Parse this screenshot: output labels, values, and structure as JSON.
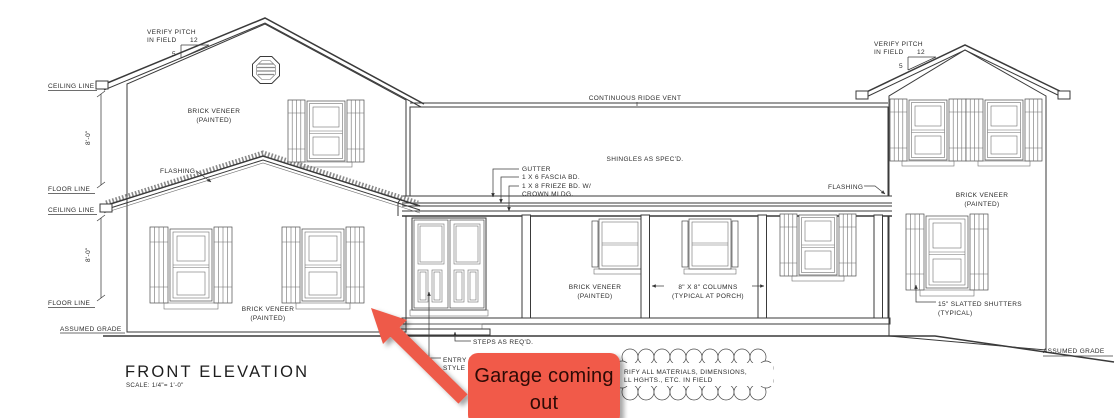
{
  "drawing": {
    "title": "FRONT ELEVATION",
    "scale_note": "SCALE: 1/4\"= 1'-0\"",
    "labels": {
      "verify_pitch": "VERIFY PITCH",
      "in_field": "IN FIELD",
      "pitch_run": "12",
      "pitch_rise": "5",
      "ceiling_line": "CEILING LINE",
      "floor_line": "FLOOR LINE",
      "dim_8ft": "8'-0\"",
      "assumed_grade": "ASSUMED GRADE",
      "brick_veneer": "BRICK VENEER",
      "painted": "(PAINTED)",
      "flashing": "FLASHING",
      "ridge_vent": "CONTINUOUS RIDGE VENT",
      "shingles": "SHINGLES AS SPEC'D.",
      "gutter": "GUTTER",
      "fascia_bd": "1 X 6 FASCIA BD.",
      "frieze_bd": "1 X 8 FRIEZE BD. W/",
      "crown_mldg": "CROWN MLDG.",
      "columns_1": "8\" X 8\" COLUMNS",
      "columns_2": "(TYPICAL AT PORCH)",
      "steps": "STEPS AS REQ'D.",
      "entry_fragment_1": "ENTRY D",
      "entry_fragment_2": "STYLE B",
      "shutters_1": "15\" SLATTED SHUTTERS",
      "shutters_2": "(TYPICAL)",
      "cloud_note_1": "RIFY ALL MATERIALS, DIMENSIONS,",
      "cloud_note_2": "LL HGHTS., ETC. IN FIELD"
    }
  },
  "annotation": {
    "text_line1": "Garage coming",
    "text_line2": "out",
    "box_color": "#f15a49",
    "arrow_color": "#ee5a48",
    "text_color": "#2d0a05"
  }
}
